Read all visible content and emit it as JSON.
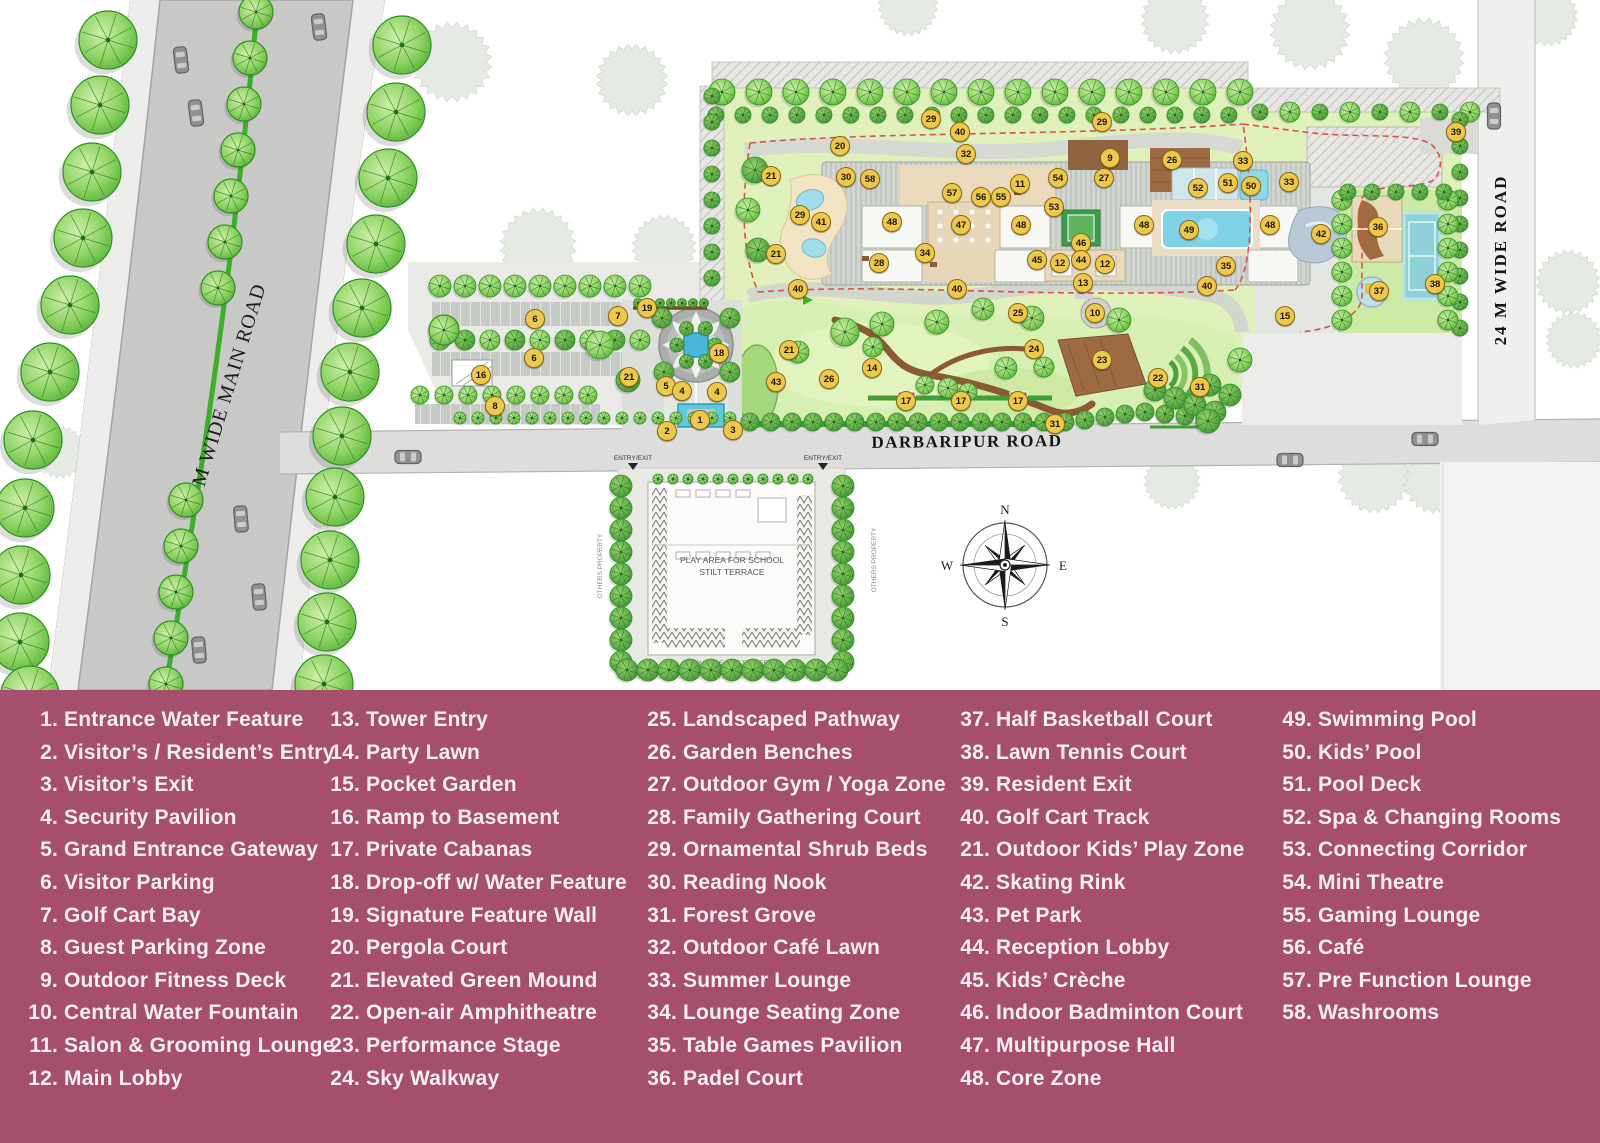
{
  "map": {
    "badge_color": "#edc94b",
    "track_red": "#d9534a",
    "water_blue": "#6fcede",
    "roads": {
      "main_road_label": "60 M WIDE MAIN ROAD",
      "darbaripur_label": "DARBARIPUR ROAD",
      "side_road_label": "24 M WIDE ROAD"
    },
    "school_plot": {
      "line1": "PLAY AREA FOR SCHOOL",
      "line2": "STILT TERRACE",
      "fire_lane": "6M WIDE FIRE TENDER",
      "entry_exit": "ENTRY/EXIT",
      "others_property": "OTHERS PROPERTY"
    },
    "compass": {
      "n": "N",
      "e": "E",
      "s": "S",
      "w": "W"
    },
    "badges": [
      {
        "n": "29",
        "x": 931,
        "y": 119
      },
      {
        "n": "40",
        "x": 960,
        "y": 132
      },
      {
        "n": "29",
        "x": 1102,
        "y": 122
      },
      {
        "n": "20",
        "x": 840,
        "y": 146
      },
      {
        "n": "32",
        "x": 966,
        "y": 154
      },
      {
        "n": "9",
        "x": 1110,
        "y": 158
      },
      {
        "n": "26",
        "x": 1172,
        "y": 160
      },
      {
        "n": "33",
        "x": 1243,
        "y": 161
      },
      {
        "n": "39",
        "x": 1456,
        "y": 132
      },
      {
        "n": "21",
        "x": 771,
        "y": 176
      },
      {
        "n": "30",
        "x": 846,
        "y": 177
      },
      {
        "n": "58",
        "x": 870,
        "y": 179
      },
      {
        "n": "11",
        "x": 1020,
        "y": 184
      },
      {
        "n": "54",
        "x": 1058,
        "y": 178
      },
      {
        "n": "27",
        "x": 1104,
        "y": 178
      },
      {
        "n": "52",
        "x": 1198,
        "y": 188
      },
      {
        "n": "51",
        "x": 1228,
        "y": 183
      },
      {
        "n": "50",
        "x": 1251,
        "y": 186
      },
      {
        "n": "33",
        "x": 1289,
        "y": 182
      },
      {
        "n": "57",
        "x": 952,
        "y": 193
      },
      {
        "n": "56",
        "x": 981,
        "y": 197
      },
      {
        "n": "55",
        "x": 1001,
        "y": 197
      },
      {
        "n": "53",
        "x": 1054,
        "y": 207
      },
      {
        "n": "29",
        "x": 800,
        "y": 215
      },
      {
        "n": "41",
        "x": 821,
        "y": 222
      },
      {
        "n": "48",
        "x": 892,
        "y": 222
      },
      {
        "n": "47",
        "x": 961,
        "y": 225
      },
      {
        "n": "48",
        "x": 1021,
        "y": 225
      },
      {
        "n": "48",
        "x": 1144,
        "y": 225
      },
      {
        "n": "49",
        "x": 1189,
        "y": 230
      },
      {
        "n": "48",
        "x": 1270,
        "y": 225
      },
      {
        "n": "42",
        "x": 1321,
        "y": 234
      },
      {
        "n": "36",
        "x": 1378,
        "y": 227
      },
      {
        "n": "46",
        "x": 1081,
        "y": 243
      },
      {
        "n": "21",
        "x": 776,
        "y": 254
      },
      {
        "n": "34",
        "x": 925,
        "y": 253
      },
      {
        "n": "28",
        "x": 879,
        "y": 263
      },
      {
        "n": "45",
        "x": 1037,
        "y": 260
      },
      {
        "n": "12",
        "x": 1060,
        "y": 263
      },
      {
        "n": "44",
        "x": 1081,
        "y": 260
      },
      {
        "n": "12",
        "x": 1105,
        "y": 264
      },
      {
        "n": "35",
        "x": 1226,
        "y": 266
      },
      {
        "n": "13",
        "x": 1083,
        "y": 283
      },
      {
        "n": "40",
        "x": 798,
        "y": 289
      },
      {
        "n": "40",
        "x": 957,
        "y": 289
      },
      {
        "n": "40",
        "x": 1207,
        "y": 286
      },
      {
        "n": "37",
        "x": 1379,
        "y": 291
      },
      {
        "n": "38",
        "x": 1435,
        "y": 284
      },
      {
        "n": "19",
        "x": 647,
        "y": 308
      },
      {
        "n": "7",
        "x": 618,
        "y": 316
      },
      {
        "n": "6",
        "x": 535,
        "y": 319
      },
      {
        "n": "25",
        "x": 1018,
        "y": 313
      },
      {
        "n": "10",
        "x": 1095,
        "y": 313
      },
      {
        "n": "15",
        "x": 1285,
        "y": 316
      },
      {
        "n": "21",
        "x": 789,
        "y": 350
      },
      {
        "n": "18",
        "x": 719,
        "y": 353
      },
      {
        "n": "24",
        "x": 1034,
        "y": 349
      },
      {
        "n": "6",
        "x": 534,
        "y": 358
      },
      {
        "n": "23",
        "x": 1102,
        "y": 360
      },
      {
        "n": "14",
        "x": 872,
        "y": 368
      },
      {
        "n": "16",
        "x": 481,
        "y": 375
      },
      {
        "n": "21",
        "x": 629,
        "y": 377
      },
      {
        "n": "22",
        "x": 1158,
        "y": 378
      },
      {
        "n": "43",
        "x": 776,
        "y": 382
      },
      {
        "n": "26",
        "x": 829,
        "y": 379
      },
      {
        "n": "31",
        "x": 1200,
        "y": 387
      },
      {
        "n": "5",
        "x": 666,
        "y": 386
      },
      {
        "n": "4",
        "x": 682,
        "y": 391
      },
      {
        "n": "4",
        "x": 717,
        "y": 392
      },
      {
        "n": "8",
        "x": 495,
        "y": 406
      },
      {
        "n": "17",
        "x": 906,
        "y": 401
      },
      {
        "n": "17",
        "x": 961,
        "y": 401
      },
      {
        "n": "17",
        "x": 1018,
        "y": 401
      },
      {
        "n": "1",
        "x": 700,
        "y": 420
      },
      {
        "n": "31",
        "x": 1055,
        "y": 424
      },
      {
        "n": "2",
        "x": 667,
        "y": 431
      },
      {
        "n": "3",
        "x": 733,
        "y": 430
      }
    ]
  },
  "legend": {
    "background": "#a64e6e",
    "text_color": "#f7eef3",
    "columns": [
      [
        {
          "num": "1.",
          "label": "Entrance Water Feature"
        },
        {
          "num": "2.",
          "label": "Visitor’s / Resident’s Entry"
        },
        {
          "num": "3.",
          "label": "Visitor’s Exit"
        },
        {
          "num": "4.",
          "label": "Security Pavilion"
        },
        {
          "num": "5.",
          "label": "Grand Entrance Gateway"
        },
        {
          "num": "6.",
          "label": "Visitor Parking"
        },
        {
          "num": "7.",
          "label": "Golf Cart Bay"
        },
        {
          "num": "8.",
          "label": "Guest Parking Zone"
        },
        {
          "num": "9.",
          "label": "Outdoor Fitness Deck"
        },
        {
          "num": "10.",
          "label": "Central Water Fountain"
        },
        {
          "num": "11.",
          "label": "Salon & Grooming Lounge"
        },
        {
          "num": "12.",
          "label": "Main Lobby"
        }
      ],
      [
        {
          "num": "13.",
          "label": "Tower Entry"
        },
        {
          "num": "14.",
          "label": "Party Lawn"
        },
        {
          "num": "15.",
          "label": "Pocket Garden"
        },
        {
          "num": "16.",
          "label": "Ramp to Basement"
        },
        {
          "num": "17.",
          "label": "Private Cabanas"
        },
        {
          "num": "18.",
          "label": "Drop-off w/ Water Feature"
        },
        {
          "num": "19.",
          "label": "Signature Feature Wall"
        },
        {
          "num": "20.",
          "label": "Pergola Court"
        },
        {
          "num": "21.",
          "label": "Elevated Green Mound"
        },
        {
          "num": "22.",
          "label": "Open-air Amphitheatre"
        },
        {
          "num": "23.",
          "label": "Performance Stage"
        },
        {
          "num": "24.",
          "label": "Sky Walkway"
        }
      ],
      [
        {
          "num": "25.",
          "label": "Landscaped Pathway"
        },
        {
          "num": "26.",
          "label": "Garden Benches"
        },
        {
          "num": "27.",
          "label": "Outdoor Gym / Yoga Zone"
        },
        {
          "num": "28.",
          "label": "Family Gathering Court"
        },
        {
          "num": "29.",
          "label": "Ornamental Shrub Beds"
        },
        {
          "num": "30.",
          "label": "Reading Nook"
        },
        {
          "num": "31.",
          "label": "Forest Grove"
        },
        {
          "num": "32.",
          "label": "Outdoor Café Lawn"
        },
        {
          "num": "33.",
          "label": "Summer Lounge"
        },
        {
          "num": "34.",
          "label": "Lounge Seating Zone"
        },
        {
          "num": "35.",
          "label": "Table Games Pavilion"
        },
        {
          "num": "36.",
          "label": "Padel Court"
        }
      ],
      [
        {
          "num": "37.",
          "label": "Half Basketball Court"
        },
        {
          "num": "38.",
          "label": "Lawn Tennis Court"
        },
        {
          "num": "39.",
          "label": "Resident Exit"
        },
        {
          "num": "40.",
          "label": "Golf Cart Track"
        },
        {
          "num": "21.",
          "label": "Outdoor Kids’ Play Zone"
        },
        {
          "num": "42.",
          "label": "Skating Rink"
        },
        {
          "num": "43.",
          "label": "Pet Park"
        },
        {
          "num": "44.",
          "label": "Reception Lobby"
        },
        {
          "num": "45.",
          "label": "Kids’ Crèche"
        },
        {
          "num": "46.",
          "label": "Indoor Badminton Court"
        },
        {
          "num": "47.",
          "label": "Multipurpose Hall"
        },
        {
          "num": "48.",
          "label": "Core Zone"
        }
      ],
      [
        {
          "num": "49.",
          "label": "Swimming Pool"
        },
        {
          "num": "50.",
          "label": "Kids’ Pool"
        },
        {
          "num": "51.",
          "label": "Pool Deck"
        },
        {
          "num": "52.",
          "label": "Spa & Changing Rooms"
        },
        {
          "num": "53.",
          "label": "Connecting Corridor"
        },
        {
          "num": "54.",
          "label": "Mini Theatre"
        },
        {
          "num": "55.",
          "label": "Gaming Lounge"
        },
        {
          "num": "56.",
          "label": "Café"
        },
        {
          "num": "57.",
          "label": "Pre Function Lounge"
        },
        {
          "num": "58.",
          "label": "Washrooms"
        }
      ]
    ]
  }
}
